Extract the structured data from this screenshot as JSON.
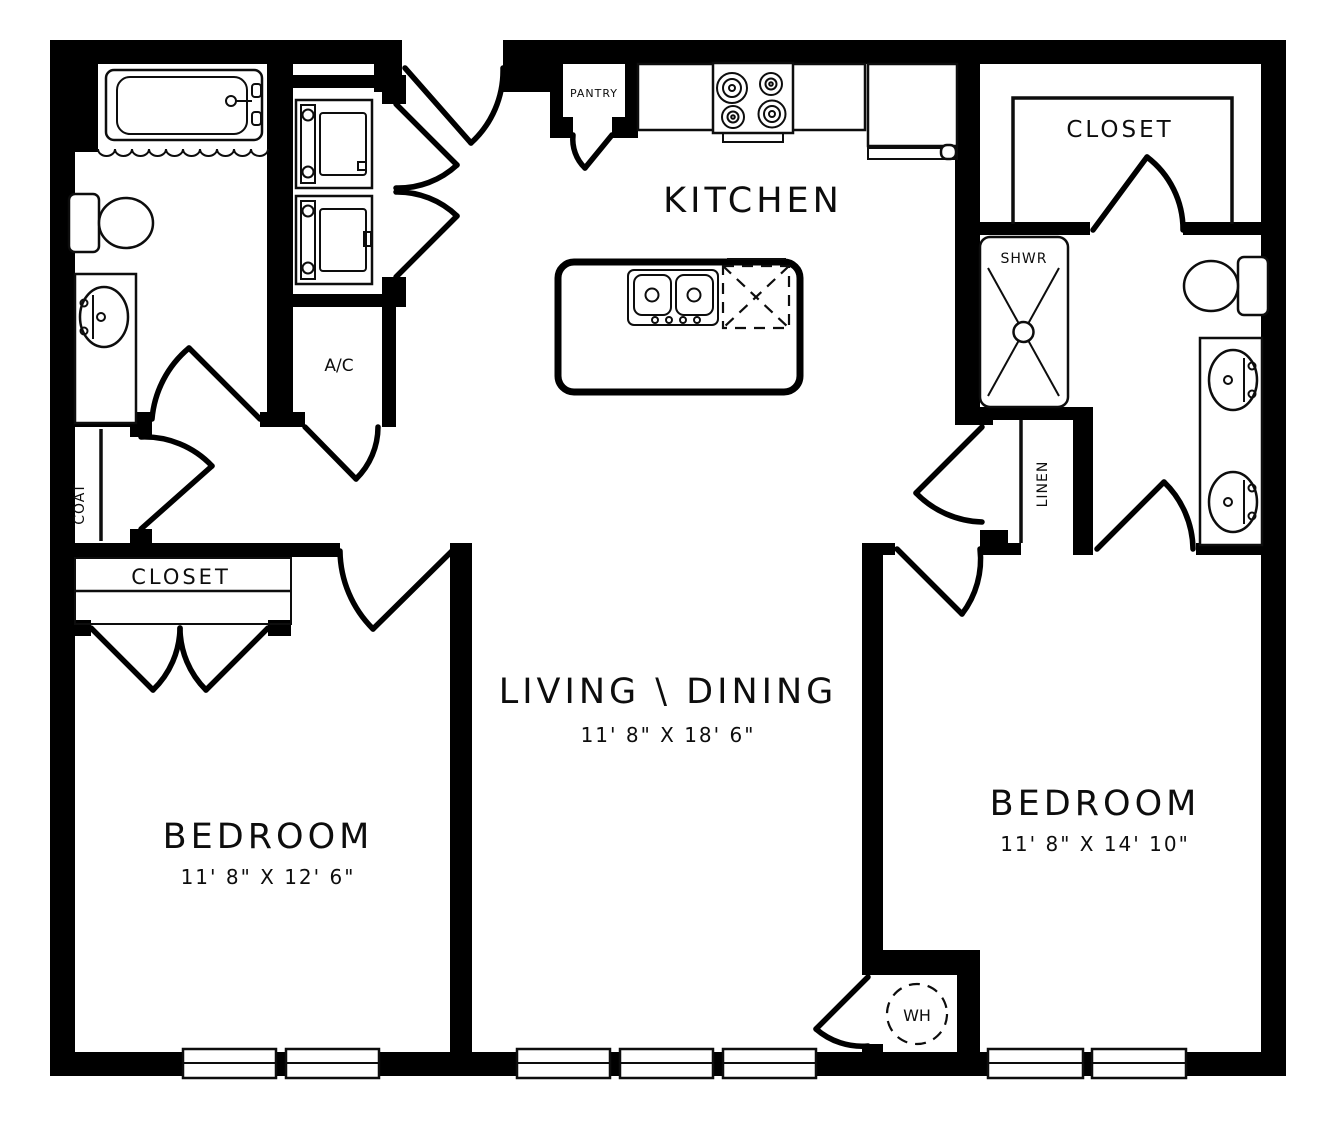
{
  "rooms": {
    "kitchen": {
      "label": "KITCHEN"
    },
    "living_dining": {
      "label": "LIVING \\ DINING",
      "dims": "11' 8\" X 18' 6\""
    },
    "bedroom_left": {
      "label": "BEDROOM",
      "dims": "11' 8\" X 12' 6\""
    },
    "bedroom_right": {
      "label": "BEDROOM",
      "dims": "11' 8\" X 14' 10\""
    }
  },
  "storage": {
    "pantry": "PANTRY",
    "walkin_closet": "CLOSET",
    "bedroom_closet": "CLOSET",
    "coat": "COAT",
    "linen": "LINEN"
  },
  "utility": {
    "ac": "A/C",
    "shower": "SHWR",
    "water_heater": "WH"
  },
  "colors": {
    "wall": "#000000",
    "background": "#ffffff"
  }
}
